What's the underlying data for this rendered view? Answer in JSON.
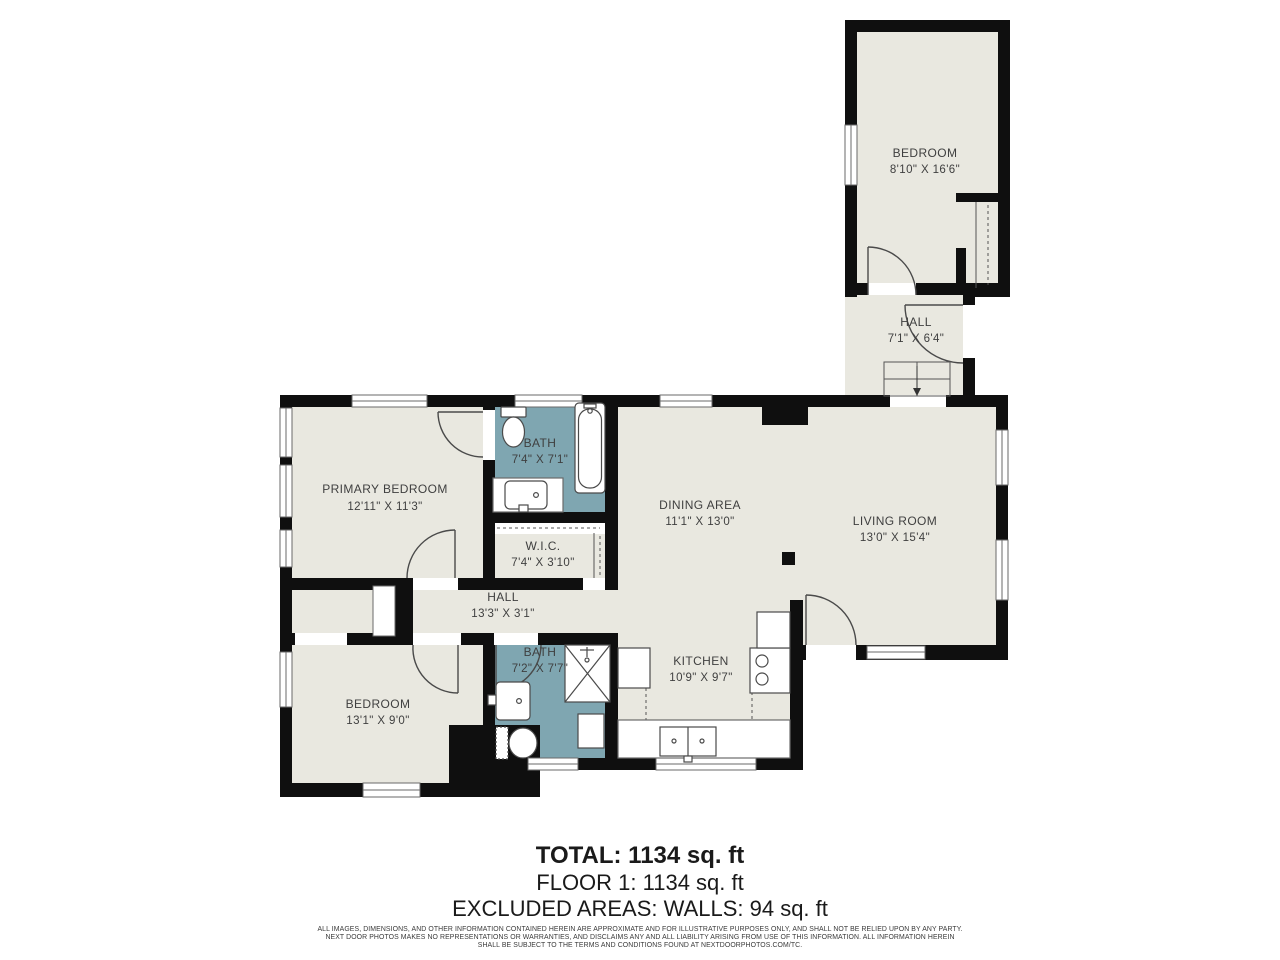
{
  "floor_plan": {
    "colors": {
      "background": "#ffffff",
      "wall": "#0f0f0f",
      "floor": "#e9e8e0",
      "bath_floor": "#7fa6b1",
      "label_text": "#3f3f3f",
      "fixture_line": "#4a4a4a"
    },
    "rooms": [
      {
        "id": "bedroom-upper",
        "name": "BEDROOM",
        "dims": "8'10\" X 16'6\""
      },
      {
        "id": "hall-upper",
        "name": "HALL",
        "dims": "7'1\" X 6'4\""
      },
      {
        "id": "primary-bedroom",
        "name": "PRIMARY BEDROOM",
        "dims": "12'11\" X 11'3\""
      },
      {
        "id": "bath-upper",
        "name": "BATH",
        "dims": "7'4\" X 7'1\""
      },
      {
        "id": "wic",
        "name": "W.I.C.",
        "dims": "7'4\" X 3'10\""
      },
      {
        "id": "dining-area",
        "name": "DINING AREA",
        "dims": "11'1\" X 13'0\""
      },
      {
        "id": "living-room",
        "name": "LIVING ROOM",
        "dims": "13'0\" X 15'4\""
      },
      {
        "id": "hall-main",
        "name": "HALL",
        "dims": "13'3\" X 3'1\""
      },
      {
        "id": "bath-lower",
        "name": "BATH",
        "dims": "7'2\" X 7'7\""
      },
      {
        "id": "bedroom-lower",
        "name": "BEDROOM",
        "dims": "13'1\" X 9'0\""
      },
      {
        "id": "kitchen",
        "name": "KITCHEN",
        "dims": "10'9\" X 9'7\""
      }
    ],
    "summary": {
      "total": "TOTAL: 1134 sq. ft",
      "floor": "FLOOR 1: 1134 sq. ft",
      "excluded": "EXCLUDED AREAS: WALLS: 94 sq. ft"
    },
    "disclaimer": {
      "line1": "ALL IMAGES, DIMENSIONS, AND OTHER INFORMATION CONTAINED HEREIN ARE APPROXIMATE AND FOR ILLUSTRATIVE PURPOSES ONLY, AND SHALL NOT BE RELIED UPON BY ANY PARTY.",
      "line2": "NEXT DOOR PHOTOS MAKES NO REPRESENTATIONS OR WARRANTIES, AND DISCLAIMS ANY AND ALL LIABILITY ARISING FROM USE OF THIS INFORMATION. ALL INFORMATION HEREIN",
      "line3": "SHALL BE SUBJECT TO THE TERMS AND CONDITIONS FOUND AT NEXTDOORPHOTOS.COM/TC."
    }
  }
}
